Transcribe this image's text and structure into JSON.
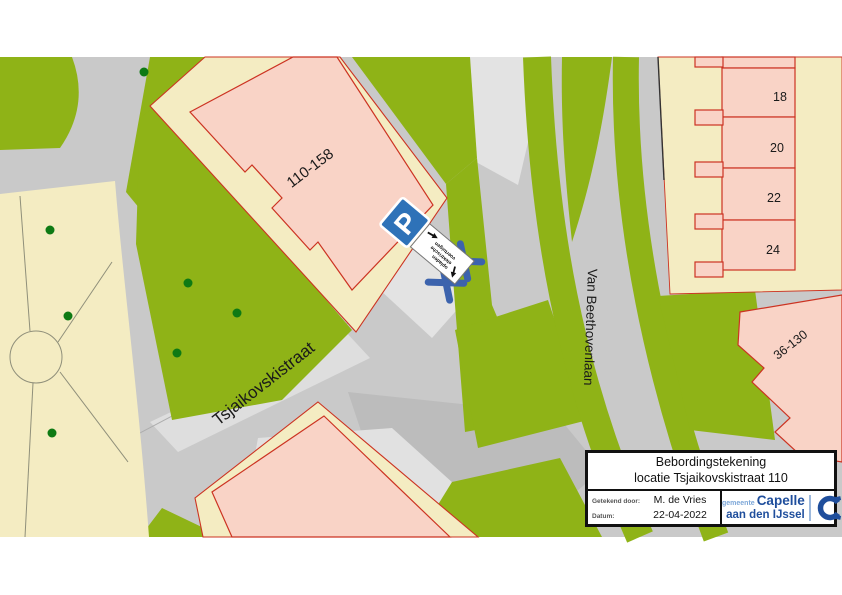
{
  "map": {
    "street_labels": [
      {
        "name": "Tsjaikovskistraat"
      },
      {
        "name": "Van Beethovenlaan"
      }
    ],
    "building_labels": [
      {
        "text": "110-158"
      },
      {
        "text": "36-130"
      }
    ],
    "houses": [
      {
        "number": "18"
      },
      {
        "number": "20"
      },
      {
        "number": "22"
      },
      {
        "number": "24"
      }
    ],
    "parking_sign": {
      "letter": "P",
      "subtext_lines": [
        "opladen",
        "elektrische",
        "voertuigen"
      ]
    },
    "colors": {
      "map_green": "#8fb317",
      "road_gray": "#c9c9c9",
      "light_gray": "#e3e3e3",
      "parcel_cream": "#f4ecc2",
      "building_pink": "#f9d3c6",
      "building_outline_red": "#cc3322",
      "sign_blue": "#2e72b8",
      "cross_blue": "#3c63ad",
      "tree_green": "#0e7a14",
      "logo_blue": "#1f4e9c",
      "logo_light_blue": "#7da7d8"
    }
  },
  "title_block": {
    "title_line1": "Bebordingstekening",
    "title_line2": "locatie Tsjaikovskistraat 110",
    "drawn_by_label": "Getekend door:",
    "drawn_by_value": "M. de Vries",
    "date_label": "Datum:",
    "date_value": "22-04-2022",
    "logo": {
      "prefix": "gemeente",
      "name_line1": "Capelle",
      "name_line2": "aan den IJssel"
    }
  }
}
